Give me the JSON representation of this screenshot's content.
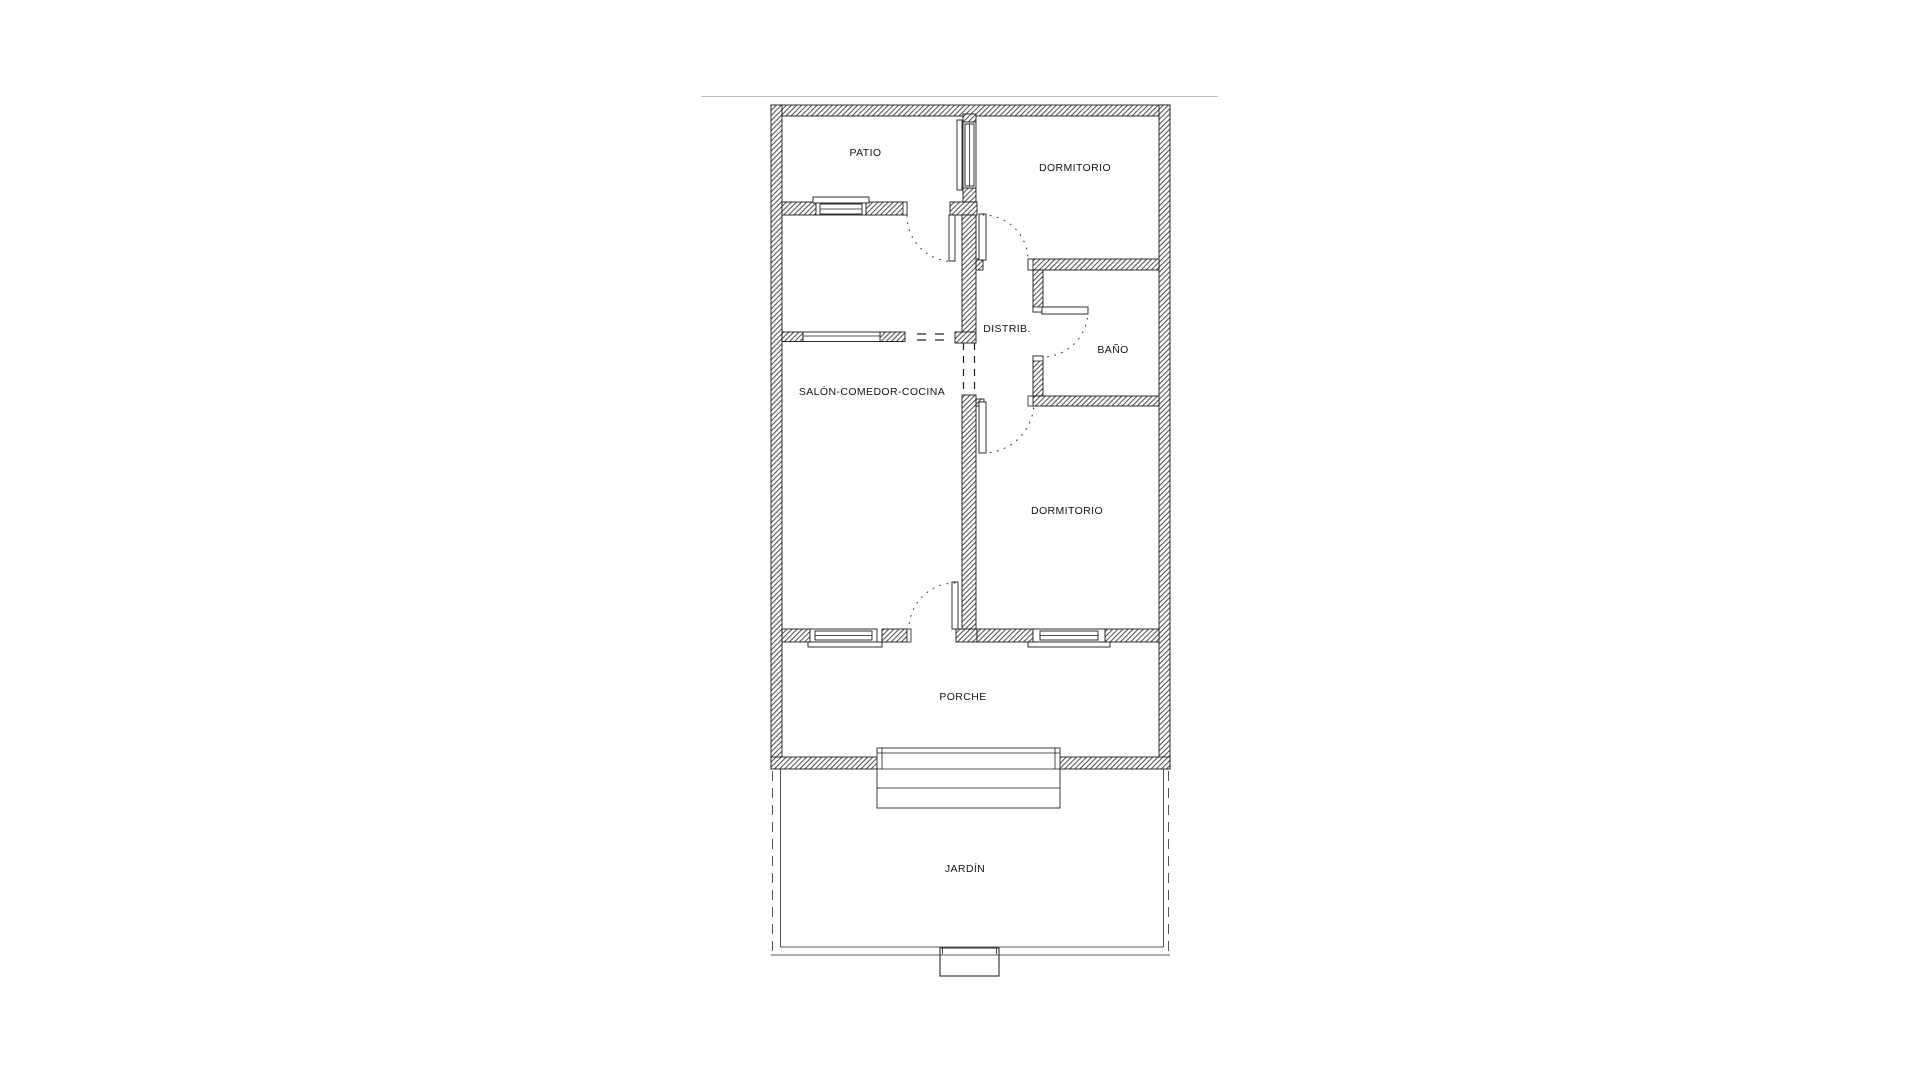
{
  "plan": {
    "rooms": [
      {
        "id": "patio",
        "label": "PATIO"
      },
      {
        "id": "dormitorio-1",
        "label": "DORMITORIO"
      },
      {
        "id": "distribuidor",
        "label": "DISTRIB."
      },
      {
        "id": "bano",
        "label": "BAÑO"
      },
      {
        "id": "salon-comedor-cocina",
        "label": "SALÓN-COMEDOR-COCINA"
      },
      {
        "id": "dormitorio-2",
        "label": "DORMITORIO"
      },
      {
        "id": "porche",
        "label": "PORCHE"
      },
      {
        "id": "jardin",
        "label": "JARDÍN"
      }
    ],
    "colors": {
      "background": "#ffffff",
      "line": "#1b1b1b",
      "hatch": "#4a4a4a",
      "separator": "#bcbcbc"
    }
  }
}
